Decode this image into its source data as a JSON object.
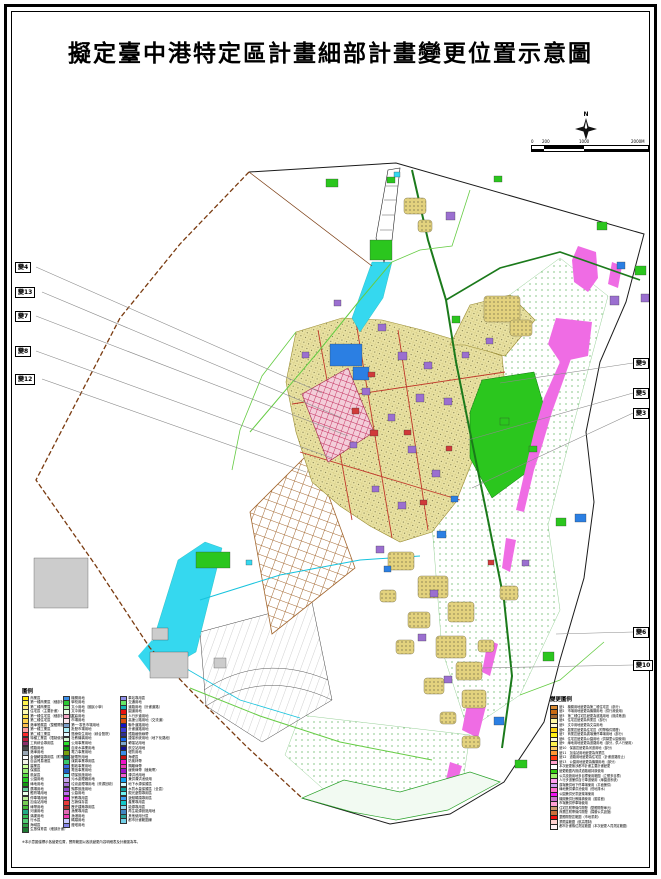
{
  "title": "擬定臺中港特定區計畫細部計畫變更位置示意圖",
  "compass": {
    "label": "N"
  },
  "scalebar": {
    "ticks": [
      "0",
      "200",
      "1000",
      "2000M"
    ]
  },
  "colors": {
    "boundary_brown": "#7a3b10",
    "boundary_black": "#1a1a1a",
    "cyan": "#35d8ef",
    "magenta": "#ef6ce4",
    "road_dark_green": "#1b7a1b",
    "road_light_green": "#66cc44",
    "green": "#2bc61e",
    "blue": "#2b7fe3",
    "purple": "#9b6fd0",
    "red": "#d03a3a",
    "gray": "#cccccc",
    "yellow": "#e3d27e",
    "leader": "#8a8a8a",
    "urban_edge": "#998c33"
  },
  "markers": [
    {
      "id": "變4",
      "side": "left",
      "x": 15,
      "y": 262,
      "tx": 322,
      "ty": 393
    },
    {
      "id": "變13",
      "side": "left",
      "x": 15,
      "y": 287,
      "tx": 342,
      "ty": 418
    },
    {
      "id": "變7",
      "side": "left",
      "x": 15,
      "y": 311,
      "tx": 348,
      "ty": 436
    },
    {
      "id": "變8",
      "side": "left",
      "x": 15,
      "y": 346,
      "tx": 332,
      "ty": 458
    },
    {
      "id": "變12",
      "side": "left",
      "x": 15,
      "y": 374,
      "tx": 306,
      "ty": 472
    },
    {
      "id": "變9",
      "side": "right",
      "x": 633,
      "y": 358,
      "tx": 500,
      "ty": 383
    },
    {
      "id": "變5",
      "side": "right",
      "x": 633,
      "y": 388,
      "tx": 468,
      "ty": 440
    },
    {
      "id": "變3",
      "side": "right",
      "x": 633,
      "y": 408,
      "tx": 472,
      "ty": 488
    },
    {
      "id": "變6",
      "side": "right",
      "x": 633,
      "y": 627,
      "tx": 556,
      "ty": 634
    },
    {
      "id": "變10",
      "side": "right",
      "x": 633,
      "y": 660,
      "tx": 482,
      "ty": 668
    }
  ],
  "legend": {
    "title": "圖例",
    "footnote": "※本示意圖僅標示各變更位置，實際範圍以各該變更內容明細表及計畫圖為準。",
    "columns": [
      {
        "x": 0,
        "items": [
          {
            "c": "#ffe800",
            "t": "商業區"
          },
          {
            "c": "#fff34d",
            "t": "第一種商業區（細部計畫）"
          },
          {
            "c": "#ffef80",
            "t": "第二種商業區"
          },
          {
            "c": "#fff9b0",
            "t": "住宅區（主要計畫）"
          },
          {
            "c": "#ffe34d",
            "t": "第一種住宅區（細部計畫擬定）"
          },
          {
            "c": "#ffd24d",
            "t": "第二種住宅區"
          },
          {
            "c": "#ffc04d",
            "t": "港埠發展區（整體開發）"
          },
          {
            "c": "#ff9ea0",
            "t": "第一種工業區"
          },
          {
            "c": "#ff2a2a",
            "t": "第二種工業區"
          },
          {
            "c": "#c21f3a",
            "t": "特種工業區（限制使用）"
          },
          {
            "c": "#8c2f6b",
            "t": "工商綜合專用區"
          },
          {
            "c": "#4a4a4a",
            "t": "鐵路用地"
          },
          {
            "c": "#9aa7b5",
            "t": "港埠用地"
          },
          {
            "c": "#ffffff",
            "t": "倉儲轉運專用區（附帶條件）"
          },
          {
            "c": "#f2f2e6",
            "t": "自由貿易港區"
          },
          {
            "c": "#ccff99",
            "t": "農業區"
          },
          {
            "c": "#99ee77",
            "t": "保護區"
          },
          {
            "c": "#55dd44",
            "t": "風景區"
          },
          {
            "c": "#22cc22",
            "t": "公園用地"
          },
          {
            "c": "#119911",
            "t": "綠地用地"
          },
          {
            "c": "#66cc99",
            "t": "廣場用地"
          },
          {
            "c": "#eaffea",
            "t": "體育場用地"
          },
          {
            "c": "#bbee99",
            "t": "停車場用地"
          },
          {
            "c": "#77cc55",
            "t": "加油站用地"
          },
          {
            "c": "#44bb33",
            "t": "綠帶用地"
          },
          {
            "c": "#22aa88",
            "t": "河道用地"
          },
          {
            "c": "#33bb55",
            "t": "溝渠用地"
          },
          {
            "c": "#55cc77",
            "t": "行水區"
          },
          {
            "c": "#2f9e44",
            "t": "海域區"
          },
          {
            "c": "#1e7a33",
            "t": "生態保育區（細部計畫）"
          }
        ]
      },
      {
        "x": 41,
        "items": [
          {
            "c": "#3b8fe8",
            "t": "機關用地"
          },
          {
            "c": "#29c832",
            "t": "學校用地"
          },
          {
            "c": "#9cf09c",
            "t": "文小用地（國民小學）"
          },
          {
            "c": "#e8ffe8",
            "t": "文中用地"
          },
          {
            "c": "#f2a7c3",
            "t": "文高用地"
          },
          {
            "c": "#fbe8ee",
            "t": "市場用地"
          },
          {
            "c": "#7d9fc9",
            "t": "第一‧零售市場用地"
          },
          {
            "c": "#aef0f7",
            "t": "批發市場用地"
          },
          {
            "c": "#e3f9ff",
            "t": "醫療衛生用地（綜合醫院）"
          },
          {
            "c": "#d6f5d6",
            "t": "社教機構用地"
          },
          {
            "c": "#2ee22e",
            "t": "公用事業用地"
          },
          {
            "c": "#0f9e0f",
            "t": "自來水事業用地"
          },
          {
            "c": "#7aa10e",
            "t": "電力事業用地"
          },
          {
            "c": "#0e6b5e",
            "t": "變電所用地"
          },
          {
            "c": "#39c96b",
            "t": "煤氣事業專用區"
          },
          {
            "c": "#3b66e0",
            "t": "郵政事業用地"
          },
          {
            "c": "#1f5fc2",
            "t": "電信事業用地"
          },
          {
            "c": "#6ff0f0",
            "t": "環保設施用地"
          },
          {
            "c": "#c9a3f0",
            "t": "污水處理廠用地"
          },
          {
            "c": "#a873d6",
            "t": "垃圾處理場用地（資源回收）"
          },
          {
            "c": "#8e46c9",
            "t": "殯葬設施用地"
          },
          {
            "c": "#c26ef0",
            "t": "公墓用地"
          },
          {
            "c": "#e81fe8",
            "t": "宗教專用區"
          },
          {
            "c": "#e83b3b",
            "t": "古蹟保存區"
          },
          {
            "c": "#b03030",
            "t": "歷史建築專用區"
          },
          {
            "c": "#e06bb4",
            "t": "漁業專用區"
          },
          {
            "c": "#f03bb4",
            "t": "漁港用地"
          },
          {
            "c": "#c9c9ff",
            "t": "碼頭用地"
          },
          {
            "c": "#8686e8",
            "t": "燈塔用地"
          }
        ]
      },
      {
        "x": 98,
        "items": [
          {
            "c": "#8f8fe8",
            "t": "車站專用區"
          },
          {
            "c": "#66e866",
            "t": "交通用地"
          },
          {
            "c": "#12b5b5",
            "t": "道路用地（計畫道路）"
          },
          {
            "c": "#e81212",
            "t": "園道用地"
          },
          {
            "c": "#f07012",
            "t": "人行步道用地"
          },
          {
            "c": "#d94f12",
            "t": "高速公路用地（交流道）"
          },
          {
            "c": "#1212c9",
            "t": "聯外道路用地"
          },
          {
            "c": "#3b3bd6",
            "t": "計畫道路用地"
          },
          {
            "c": "#2f2f8f",
            "t": "鐵路緩衝綠帶"
          },
          {
            "c": "#1266f0",
            "t": "捷運系統用地（地下化路段）"
          },
          {
            "c": "#7da7cc",
            "t": "轉運站用地"
          },
          {
            "c": "#12128f",
            "t": "航空站用地"
          },
          {
            "c": "#3b8fe8",
            "t": "堤防用地"
          },
          {
            "c": "#c91212",
            "t": "海堤區"
          },
          {
            "c": "#f012c9",
            "t": "防風林帶"
          },
          {
            "c": "#e83bb4",
            "t": "隔離綠帶"
          },
          {
            "c": "#9e12c9",
            "t": "緩衝綠帶（植栽帶）"
          },
          {
            "c": "#f05fd0",
            "t": "滯洪池用地"
          },
          {
            "c": "#12a0f0",
            "t": "兼供滯洪池使用"
          },
          {
            "c": "#ccf7ff",
            "t": "地下水源保護區"
          },
          {
            "c": "#0f9e9e",
            "t": "水質水量保護區（全區）"
          },
          {
            "c": "#6ff0f0",
            "t": "觀光遊憩專用區"
          },
          {
            "c": "#3b9ef0",
            "t": "遊艇碼頭專用區"
          },
          {
            "c": "#12c9c9",
            "t": "產業專用區"
          },
          {
            "c": "#8fd6f0",
            "t": "能源專用區"
          },
          {
            "c": "#4287c2",
            "t": "再生能源設施用地"
          },
          {
            "c": "#2aa198",
            "t": "其他使用分區"
          },
          {
            "c": "#73d0e8",
            "t": "都市計畫範圍線"
          }
        ]
      }
    ]
  },
  "changes": {
    "title": "變更圖例",
    "rows": [
      {
        "c": "#d98a33",
        "t": "變1　機關用地變更為第二種住宅區（部分）"
      },
      {
        "c": "#c96a12",
        "t": "變2　市場用地變更為機關用地（供行政使用）"
      },
      {
        "c": "#a3672f",
        "t": "變3　第二種住宅區變更為道路用地（既成巷道）"
      },
      {
        "c": "#fff9a0",
        "t": "變4　住宅區變更為商業區（部分）"
      },
      {
        "c": "#fffad6",
        "t": "變5　文中用地變更為文高用地"
      },
      {
        "c": "#ffd312",
        "t": "變6　農業區變更為住宅區（附帶條件開發）"
      },
      {
        "c": "#fff012",
        "t": "變7　商業區變更為廣場兼停車場用地（部分）"
      },
      {
        "c": "#fffad6",
        "t": "變8　住宅區變更為公園用地（供鄰里公園使用）"
      },
      {
        "c": "#fff34d",
        "t": "變9　綠地用地變更為道路用地（部分，供人行使用）"
      },
      {
        "c": "#ffcc66",
        "t": "變10　保護區變更為河道用地（部分）"
      },
      {
        "c": "#ff9633",
        "t": "變11　加油站用地變更為商業區"
      },
      {
        "c": "#ff3b12",
        "t": "變12　道路用地變更為住宅區（計畫道路廢止）"
      },
      {
        "c": "#ffa0cc",
        "t": "變13　公園用地變更為機關用地（部分）"
      },
      {
        "c": "#ffffff",
        "t": "本次變更無涉都市計畫主要計畫變更"
      },
      {
        "c": "#33cc12",
        "t": "變更範圍內既成道路維持原使用"
      },
      {
        "c": "#a0f070",
        "t": "公共設施用地多目標使用範圍（立體多目標）"
      },
      {
        "c": "#ff9ef0",
        "t": "人行步道兼供自行車道使用（綠園道系統）"
      },
      {
        "c": "#cc9ef0",
        "t": "廣場兼供地下停車場使用（平面兼供）"
      },
      {
        "c": "#ff70cc",
        "t": "綠地兼供滯洪池使用（低地排水）"
      },
      {
        "c": "#f012f0",
        "t": "公園兼供兒童遊樂場使用"
      },
      {
        "c": "#c970c9",
        "t": "機關兼供社教機構使用（圖書館）"
      },
      {
        "c": "#ffa0d6",
        "t": "市場兼供停車場使用"
      },
      {
        "c": "#cc9670",
        "t": "住宅區附帶條件開發（整體開發單元）"
      },
      {
        "c": "#c9703b",
        "t": "商業區附帶條件開發（捐贈公共設施）"
      },
      {
        "c": "#f01212",
        "t": "整體開發區範圍（市地重劃）"
      },
      {
        "c": "#ffd0d0",
        "t": "禁限建範圍（航高限制）"
      },
      {
        "c": "#fff0f5",
        "t": "都市計畫樁位測定範圍（本次變更人員測定範圍）"
      }
    ]
  },
  "map": {
    "parcels": [
      [
        330,
        344,
        32,
        22,
        "blue"
      ],
      [
        353,
        367,
        16,
        13,
        "blue"
      ],
      [
        437,
        531,
        9,
        7,
        "blue"
      ],
      [
        575,
        514,
        11,
        8,
        "blue"
      ],
      [
        617,
        262,
        8,
        7,
        "blue"
      ],
      [
        494,
        717,
        10,
        8,
        "blue"
      ],
      [
        451,
        496,
        7,
        6,
        "blue"
      ],
      [
        384,
        566,
        7,
        6,
        "blue"
      ],
      [
        196,
        552,
        34,
        16,
        "green"
      ],
      [
        370,
        240,
        22,
        20,
        "green"
      ],
      [
        326,
        179,
        12,
        8,
        "green"
      ],
      [
        597,
        222,
        10,
        8,
        "green"
      ],
      [
        635,
        266,
        11,
        9,
        "green"
      ],
      [
        556,
        518,
        10,
        8,
        "green"
      ],
      [
        543,
        652,
        11,
        9,
        "green"
      ],
      [
        515,
        760,
        12,
        8,
        "green"
      ],
      [
        387,
        177,
        8,
        6,
        "green"
      ],
      [
        494,
        176,
        8,
        6,
        "green"
      ],
      [
        452,
        316,
        8,
        7,
        "green"
      ],
      [
        500,
        418,
        9,
        7,
        "green"
      ],
      [
        529,
        446,
        8,
        6,
        "green"
      ],
      [
        446,
        212,
        9,
        8,
        "purple"
      ],
      [
        378,
        324,
        8,
        7,
        "purple"
      ],
      [
        398,
        352,
        9,
        8,
        "purple"
      ],
      [
        424,
        362,
        8,
        7,
        "purple"
      ],
      [
        416,
        394,
        8,
        8,
        "purple"
      ],
      [
        444,
        398,
        8,
        7,
        "purple"
      ],
      [
        388,
        414,
        7,
        7,
        "purple"
      ],
      [
        362,
        388,
        8,
        7,
        "purple"
      ],
      [
        350,
        442,
        7,
        6,
        "purple"
      ],
      [
        408,
        446,
        8,
        7,
        "purple"
      ],
      [
        432,
        470,
        8,
        7,
        "purple"
      ],
      [
        372,
        486,
        7,
        6,
        "purple"
      ],
      [
        398,
        502,
        8,
        7,
        "purple"
      ],
      [
        462,
        352,
        7,
        6,
        "purple"
      ],
      [
        486,
        338,
        7,
        6,
        "purple"
      ],
      [
        610,
        296,
        9,
        9,
        "purple"
      ],
      [
        641,
        294,
        8,
        8,
        "purple"
      ],
      [
        430,
        590,
        8,
        7,
        "purple"
      ],
      [
        376,
        546,
        8,
        7,
        "purple"
      ],
      [
        418,
        634,
        8,
        7,
        "purple"
      ],
      [
        444,
        676,
        8,
        7,
        "purple"
      ],
      [
        522,
        560,
        7,
        6,
        "purple"
      ],
      [
        334,
        300,
        7,
        6,
        "purple"
      ],
      [
        302,
        352,
        7,
        6,
        "purple"
      ],
      [
        370,
        430,
        8,
        6,
        "red"
      ],
      [
        352,
        408,
        7,
        6,
        "red"
      ],
      [
        404,
        430,
        7,
        5,
        "red"
      ],
      [
        420,
        500,
        7,
        5,
        "red"
      ],
      [
        446,
        446,
        6,
        5,
        "red"
      ],
      [
        488,
        560,
        6,
        5,
        "red"
      ],
      [
        368,
        372,
        7,
        5,
        "red"
      ],
      [
        34,
        558,
        54,
        50,
        "gray"
      ],
      [
        150,
        652,
        38,
        26,
        "gray"
      ],
      [
        214,
        658,
        12,
        10,
        "gray"
      ],
      [
        152,
        628,
        16,
        12,
        "gray"
      ],
      [
        394,
        172,
        6,
        5,
        "cyan"
      ],
      [
        246,
        560,
        6,
        5,
        "cyan"
      ]
    ],
    "villages": [
      [
        388,
        552,
        26,
        18
      ],
      [
        418,
        576,
        30,
        22
      ],
      [
        448,
        602,
        26,
        20
      ],
      [
        408,
        612,
        22,
        16
      ],
      [
        436,
        636,
        30,
        22
      ],
      [
        456,
        662,
        26,
        18
      ],
      [
        424,
        678,
        20,
        16
      ],
      [
        462,
        690,
        24,
        18
      ],
      [
        396,
        640,
        18,
        14
      ],
      [
        478,
        640,
        16,
        12
      ],
      [
        484,
        296,
        36,
        26
      ],
      [
        510,
        320,
        22,
        16
      ],
      [
        404,
        198,
        22,
        16
      ],
      [
        418,
        220,
        14,
        12
      ],
      [
        462,
        736,
        18,
        12
      ],
      [
        440,
        712,
        16,
        12
      ],
      [
        500,
        586,
        18,
        14
      ],
      [
        380,
        590,
        16,
        12
      ]
    ]
  }
}
